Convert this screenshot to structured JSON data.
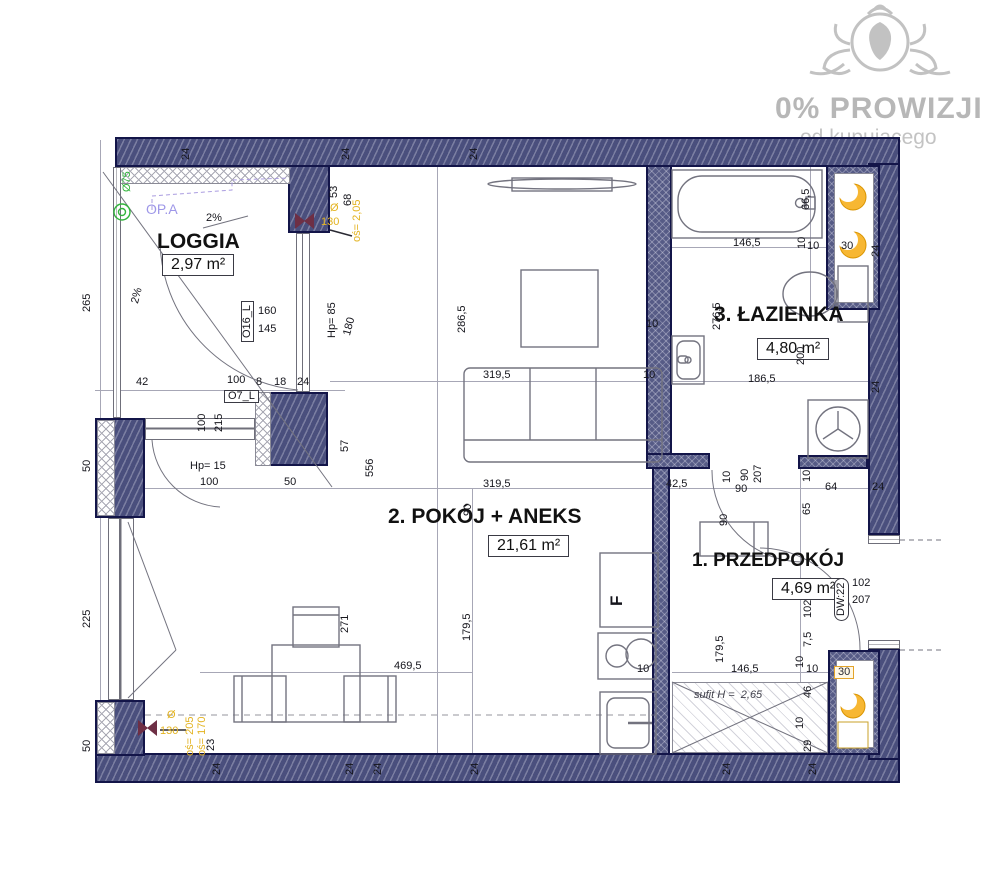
{
  "watermark": {
    "line1": "0% PROWIZJI",
    "line2": "od kupującego",
    "logo": "lion-ornament-logo",
    "color": "#b7b7b7"
  },
  "rooms": {
    "loggia": {
      "name": "LOGGIA",
      "area": "2,97 m²"
    },
    "living": {
      "name": "2. POKÓJ + ANEKS",
      "area": "21,61 m²"
    },
    "bath": {
      "name": "3. ŁAZIENKA",
      "area": "4,80 m²"
    },
    "hall": {
      "name": "1. PRZEDPOKÓJ",
      "area": "4,69 m²"
    }
  },
  "colors": {
    "wall": "#4a4f7d",
    "wall_border": "#131549",
    "vent_yellow": "#f7b733",
    "drain_green": "#32b43c",
    "duct_maroon": "#6e2f45",
    "label_yellow": "#e3b320",
    "label_purple": "#9e97e8"
  },
  "symbols": [
    "drain-icon",
    "vent-crescent-icon",
    "duct-bowtie-icon",
    "washer-icon",
    "cooktop-icon",
    "bathtub-icon",
    "toilet-icon",
    "sink-icon",
    "radiator-icon"
  ],
  "dimensions": [
    {
      "t": "265",
      "x": 82,
      "y": 312,
      "r": -90
    },
    {
      "t": "50",
      "x": 82,
      "y": 472,
      "r": -90
    },
    {
      "t": "225",
      "x": 82,
      "y": 628,
      "r": -90
    },
    {
      "t": "50",
      "x": 82,
      "y": 752,
      "r": -90
    },
    {
      "t": "Ø75",
      "x": 122,
      "y": 192,
      "r": -90,
      "k": "gr"
    },
    {
      "t": "OP.A",
      "x": 146,
      "y": 204,
      "r": 0,
      "k": "pu"
    },
    {
      "t": "2%",
      "x": 206,
      "y": 213,
      "r": 0
    },
    {
      "t": "2%",
      "x": 130,
      "y": 302,
      "r": -75
    },
    {
      "t": "O16_L",
      "x": 241,
      "y": 342,
      "r": -90,
      "k": "bx"
    },
    {
      "t": "160",
      "x": 258,
      "y": 306,
      "r": 0
    },
    {
      "t": "145",
      "x": 258,
      "y": 324,
      "r": 0
    },
    {
      "t": "Hp= 85",
      "x": 327,
      "y": 338,
      "r": -90
    },
    {
      "t": "180",
      "x": 342,
      "y": 334,
      "r": -75
    },
    {
      "t": "53",
      "x": 329,
      "y": 198,
      "r": -90
    },
    {
      "t": "68",
      "x": 343,
      "y": 206,
      "r": -90
    },
    {
      "t": "Ø",
      "x": 330,
      "y": 203,
      "r": 0,
      "k": "yl"
    },
    {
      "t": "130",
      "x": 321,
      "y": 217,
      "r": 0,
      "k": "yl"
    },
    {
      "t": "oś= 2,05",
      "x": 352,
      "y": 242,
      "r": -90,
      "k": "yl"
    },
    {
      "t": "42",
      "x": 136,
      "y": 377,
      "r": 0
    },
    {
      "t": "100",
      "x": 227,
      "y": 375,
      "r": 0
    },
    {
      "t": "O7_L",
      "x": 224,
      "y": 390,
      "r": 0,
      "k": "bx"
    },
    {
      "t": "8",
      "x": 256,
      "y": 377,
      "r": 0
    },
    {
      "t": "18",
      "x": 274,
      "y": 377,
      "r": 0
    },
    {
      "t": "24",
      "x": 297,
      "y": 377,
      "r": 0
    },
    {
      "t": "100",
      "x": 197,
      "y": 432,
      "r": -90
    },
    {
      "t": "215",
      "x": 214,
      "y": 432,
      "r": -90
    },
    {
      "t": "Hp= 15",
      "x": 190,
      "y": 461,
      "r": 0
    },
    {
      "t": "100",
      "x": 200,
      "y": 477,
      "r": 0
    },
    {
      "t": "50",
      "x": 284,
      "y": 477,
      "r": 0
    },
    {
      "t": "57",
      "x": 340,
      "y": 452,
      "r": -90
    },
    {
      "t": "556",
      "x": 365,
      "y": 477,
      "r": -90
    },
    {
      "t": "286,5",
      "x": 457,
      "y": 333,
      "r": -90
    },
    {
      "t": "10",
      "x": 646,
      "y": 319,
      "r": 0
    },
    {
      "t": "319,5",
      "x": 483,
      "y": 370,
      "r": 0
    },
    {
      "t": "10",
      "x": 643,
      "y": 370,
      "r": 0
    },
    {
      "t": "319,5",
      "x": 483,
      "y": 479,
      "r": 0
    },
    {
      "t": "90",
      "x": 463,
      "y": 516,
      "r": -90
    },
    {
      "t": "42,5",
      "x": 666,
      "y": 479,
      "r": 0
    },
    {
      "t": "10",
      "x": 722,
      "y": 483,
      "r": -90
    },
    {
      "t": "90",
      "x": 740,
      "y": 481,
      "r": -90
    },
    {
      "t": "207",
      "x": 753,
      "y": 483,
      "r": -90
    },
    {
      "t": "90",
      "x": 735,
      "y": 484,
      "r": 0
    },
    {
      "t": "90",
      "x": 719,
      "y": 526,
      "r": -90
    },
    {
      "t": "65",
      "x": 802,
      "y": 515,
      "r": -90
    },
    {
      "t": "10",
      "x": 802,
      "y": 482,
      "r": -90
    },
    {
      "t": "64",
      "x": 825,
      "y": 482,
      "r": 0
    },
    {
      "t": "24",
      "x": 872,
      "y": 482,
      "r": 0
    },
    {
      "t": "F",
      "x": 611,
      "y": 606,
      "r": -90,
      "k": "big2"
    },
    {
      "t": "10",
      "x": 637,
      "y": 664,
      "r": 0
    },
    {
      "t": "271",
      "x": 340,
      "y": 633,
      "r": -90
    },
    {
      "t": "469,5",
      "x": 394,
      "y": 661,
      "r": 0
    },
    {
      "t": "179,5",
      "x": 462,
      "y": 641,
      "r": -90
    },
    {
      "t": "23",
      "x": 206,
      "y": 751,
      "r": -90
    },
    {
      "t": "Ø",
      "x": 167,
      "y": 710,
      "r": 0,
      "k": "yl"
    },
    {
      "t": "130",
      "x": 160,
      "y": 726,
      "r": 0,
      "k": "yl"
    },
    {
      "t": "oś= 205",
      "x": 185,
      "y": 756,
      "r": -90,
      "k": "yl"
    },
    {
      "t": "oś= 170",
      "x": 197,
      "y": 756,
      "r": -90,
      "k": "yl"
    },
    {
      "t": "179,5",
      "x": 715,
      "y": 663,
      "r": -90
    },
    {
      "t": "146,5",
      "x": 731,
      "y": 664,
      "r": 0
    },
    {
      "t": "10",
      "x": 806,
      "y": 664,
      "r": 0
    },
    {
      "t": "7,5",
      "x": 803,
      "y": 647,
      "r": -90
    },
    {
      "t": "10",
      "x": 795,
      "y": 668,
      "r": -90
    },
    {
      "t": "102",
      "x": 803,
      "y": 618,
      "r": -90
    },
    {
      "t": "DW:22",
      "x": 834,
      "y": 621,
      "r": -90,
      "k": "ov"
    },
    {
      "t": "102",
      "x": 852,
      "y": 578,
      "r": 0
    },
    {
      "t": "207",
      "x": 852,
      "y": 595,
      "r": 0
    },
    {
      "t": "46",
      "x": 803,
      "y": 698,
      "r": -90
    },
    {
      "t": "10",
      "x": 795,
      "y": 729,
      "r": -90
    },
    {
      "t": "29",
      "x": 803,
      "y": 752,
      "r": -90
    },
    {
      "t": "30",
      "x": 834,
      "y": 666,
      "r": 0,
      "k": "or"
    },
    {
      "t": "sufit H =  2,65",
      "x": 694,
      "y": 690,
      "r": 0,
      "k": "it"
    },
    {
      "t": "146,5",
      "x": 733,
      "y": 238,
      "r": 0
    },
    {
      "t": "10",
      "x": 797,
      "y": 249,
      "r": -90
    },
    {
      "t": "10",
      "x": 807,
      "y": 241,
      "r": 0
    },
    {
      "t": "30",
      "x": 841,
      "y": 241,
      "r": 0
    },
    {
      "t": "24",
      "x": 871,
      "y": 257,
      "r": -90
    },
    {
      "t": "66,5",
      "x": 801,
      "y": 210,
      "r": -90
    },
    {
      "t": "276,5",
      "x": 712,
      "y": 330,
      "r": -90
    },
    {
      "t": "200",
      "x": 796,
      "y": 365,
      "r": -90
    },
    {
      "t": "186,5",
      "x": 748,
      "y": 374,
      "r": 0
    },
    {
      "t": "24",
      "x": 871,
      "y": 393,
      "r": -90
    },
    {
      "t": "24",
      "x": 181,
      "y": 160,
      "r": -90
    },
    {
      "t": "24",
      "x": 341,
      "y": 160,
      "r": -90
    },
    {
      "t": "24",
      "x": 469,
      "y": 160,
      "r": -90
    },
    {
      "t": "24",
      "x": 212,
      "y": 775,
      "r": -90
    },
    {
      "t": "24",
      "x": 345,
      "y": 775,
      "r": -90
    },
    {
      "t": "24",
      "x": 373,
      "y": 775,
      "r": -90
    },
    {
      "t": "24",
      "x": 470,
      "y": 775,
      "r": -90
    },
    {
      "t": "24",
      "x": 722,
      "y": 775,
      "r": -90
    },
    {
      "t": "24",
      "x": 808,
      "y": 775,
      "r": -90
    }
  ]
}
